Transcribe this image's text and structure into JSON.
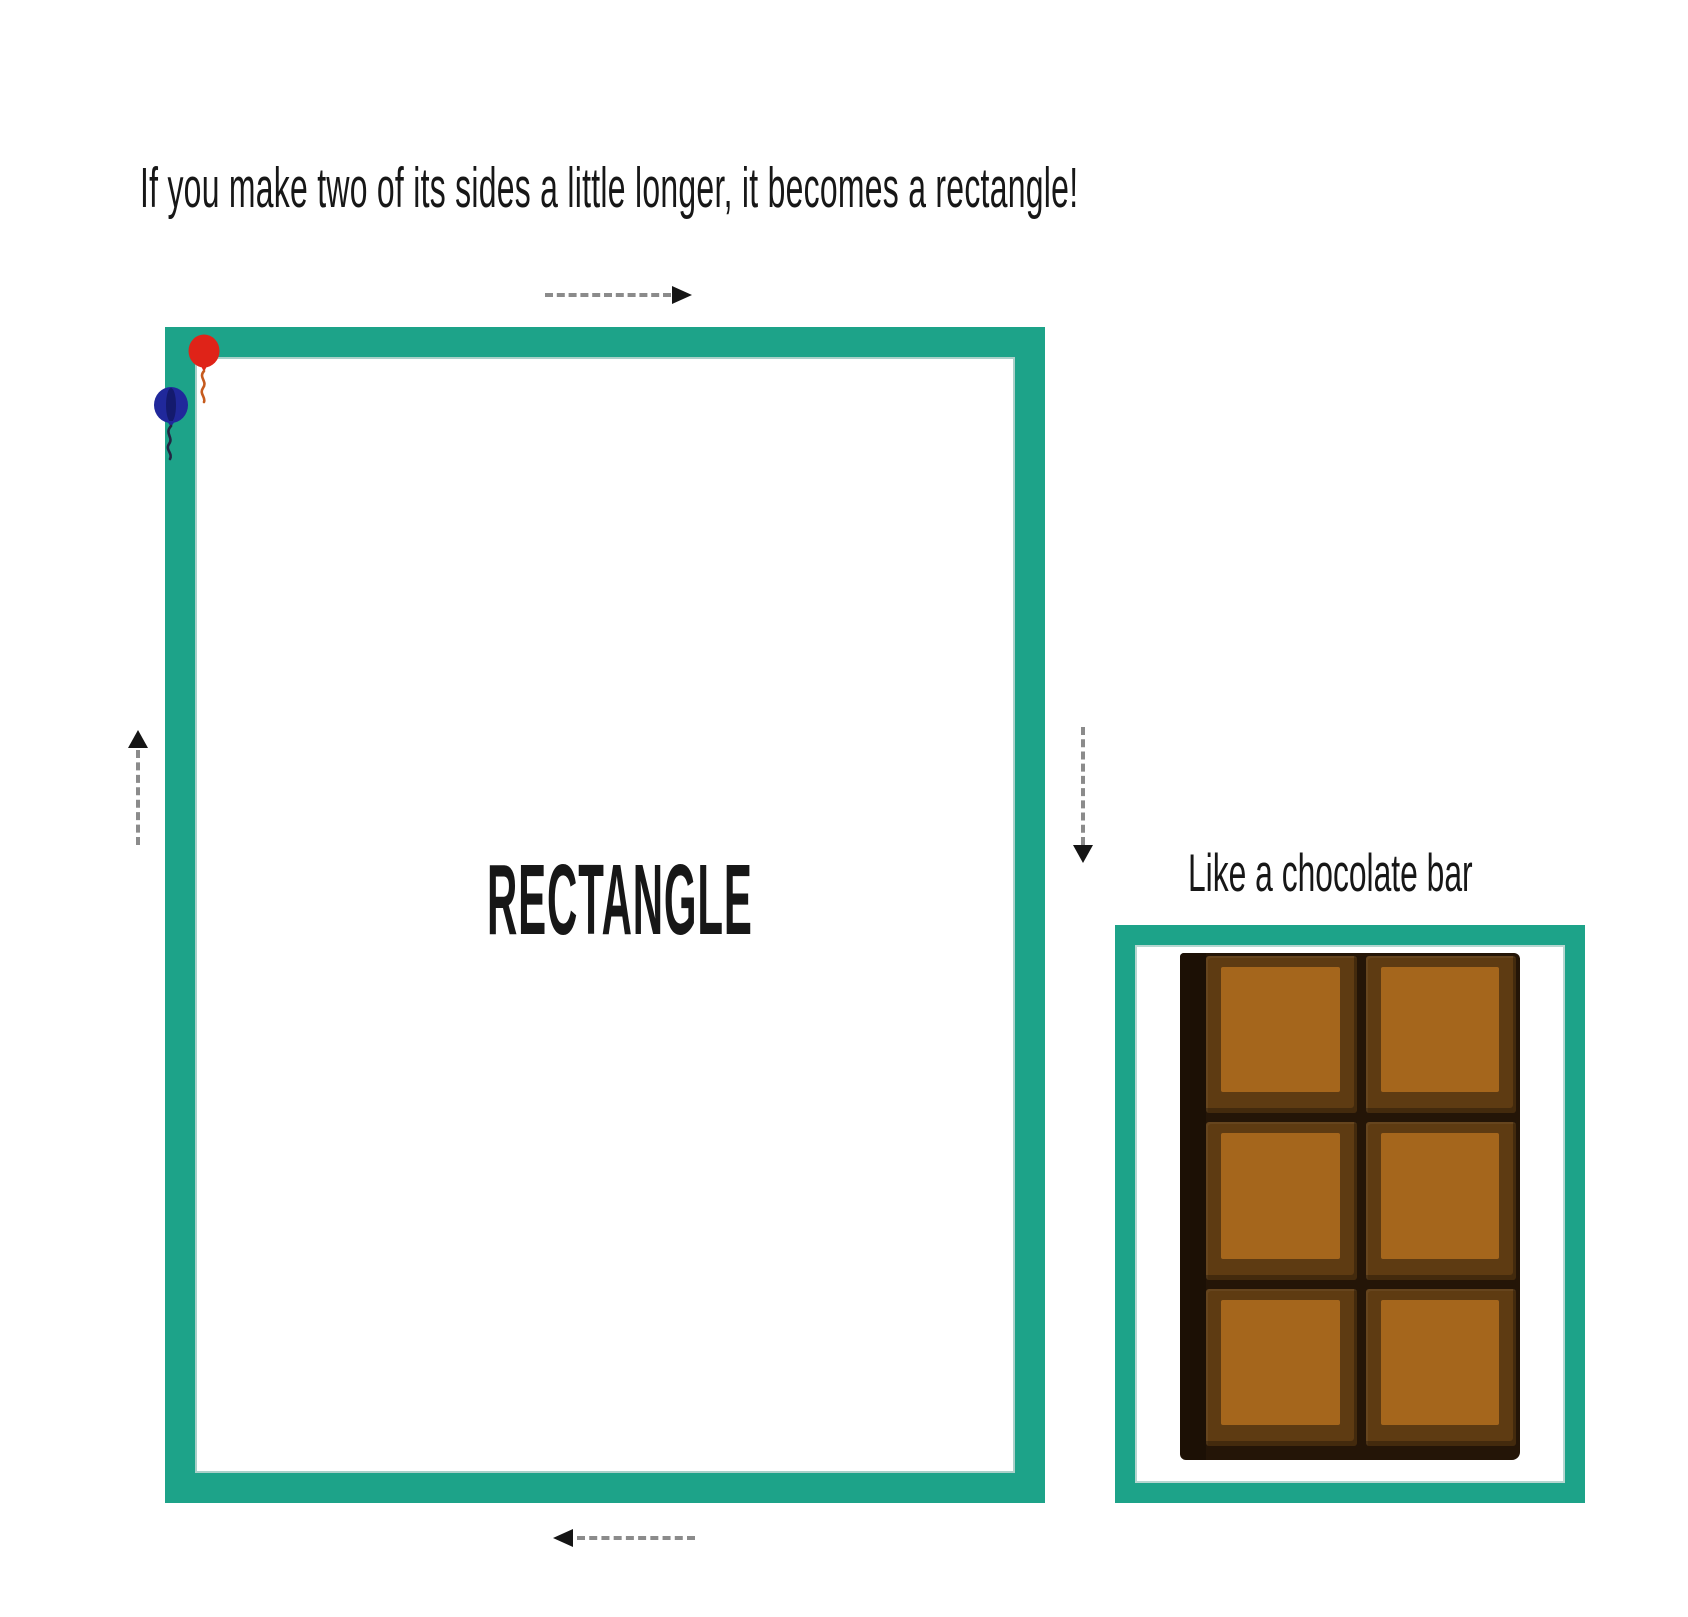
{
  "page": {
    "title": "If you make two of its sides a little longer, it becomes a rectangle!",
    "background": "#ffffff"
  },
  "rectangle": {
    "label": "RECTANGLE",
    "border_color": "#1da389"
  },
  "chocolate": {
    "caption": "Like a chocolate bar",
    "frame_border_color": "#1da389",
    "grid": {
      "rows": 3,
      "cols": 2
    },
    "colors": {
      "face": "#a5661c",
      "bevel": "#5e3b12",
      "groove": "#241507",
      "side_shadow": "#1c1005"
    }
  },
  "balloons": [
    {
      "name": "red-balloon",
      "color": "#df2318",
      "string_color": "#c65b1e"
    },
    {
      "name": "blue-balloon",
      "color": "#20289b",
      "string_color": "#232542"
    }
  ],
  "arrows": {
    "dash_color": "#8b8b8b",
    "head_color": "#151515",
    "items": [
      {
        "side": "top",
        "direction": "right"
      },
      {
        "side": "left",
        "direction": "up"
      },
      {
        "side": "right",
        "direction": "down"
      },
      {
        "side": "bottom",
        "direction": "left"
      }
    ]
  }
}
